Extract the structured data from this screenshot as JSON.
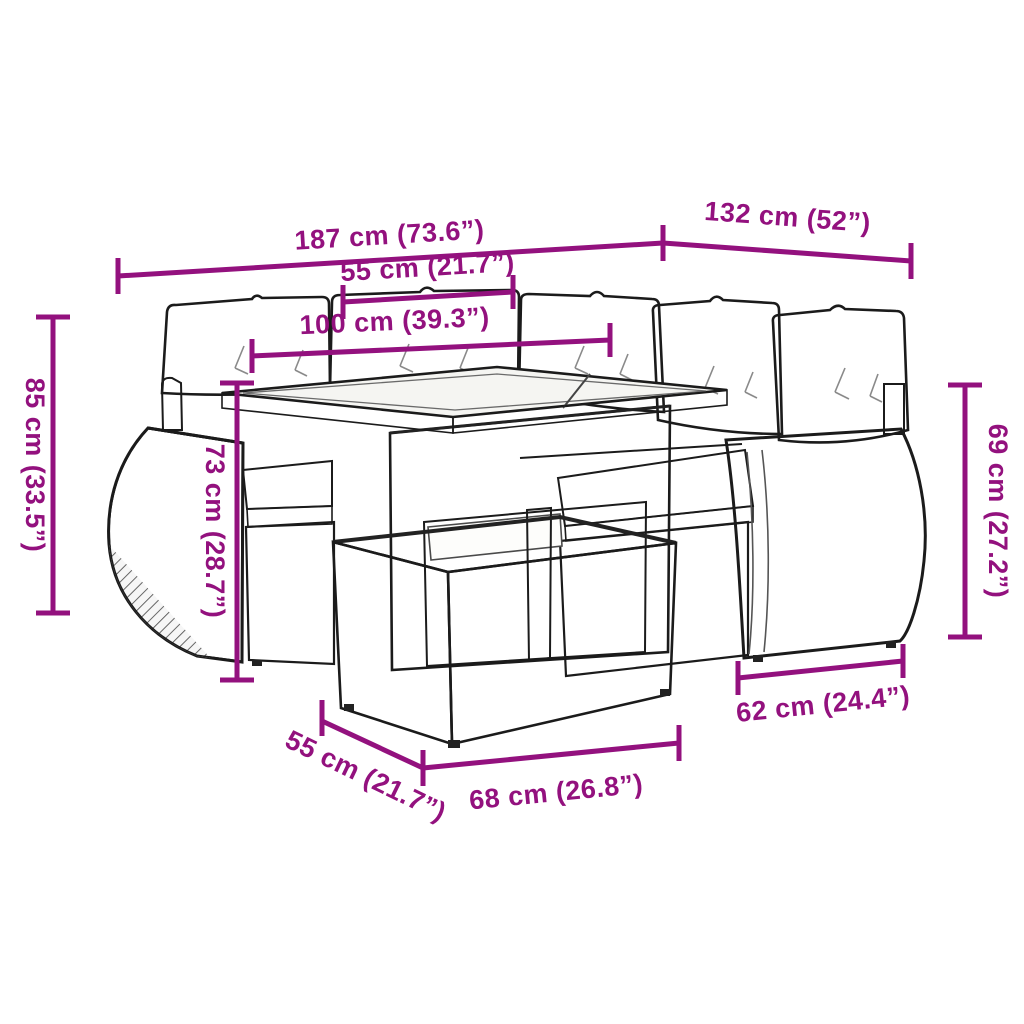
{
  "diagram": {
    "kind": "product-dimension-diagram",
    "product": "Garden lounge set with cushions, glass-top table and rattan stool",
    "background_color": "#ffffff",
    "accent_color": "#93117E",
    "line_art_color": "#1b1b1b",
    "cushion_color": "#ffffff"
  },
  "dims": {
    "overall_length": "187 cm (73.6”)",
    "overall_depth": "132 cm (52”)",
    "table_width": "55 cm (21.7”)",
    "table_length": "100 cm (39.3”)",
    "total_height": "85 cm (33.5”)",
    "table_height": "73 cm (28.7”)",
    "armrest_height": "69 cm (27.2”)",
    "seat_depth": "62 cm (24.4”)",
    "stool_depth": "55 cm (21.7”)",
    "stool_width": "68 cm (26.8”)"
  }
}
